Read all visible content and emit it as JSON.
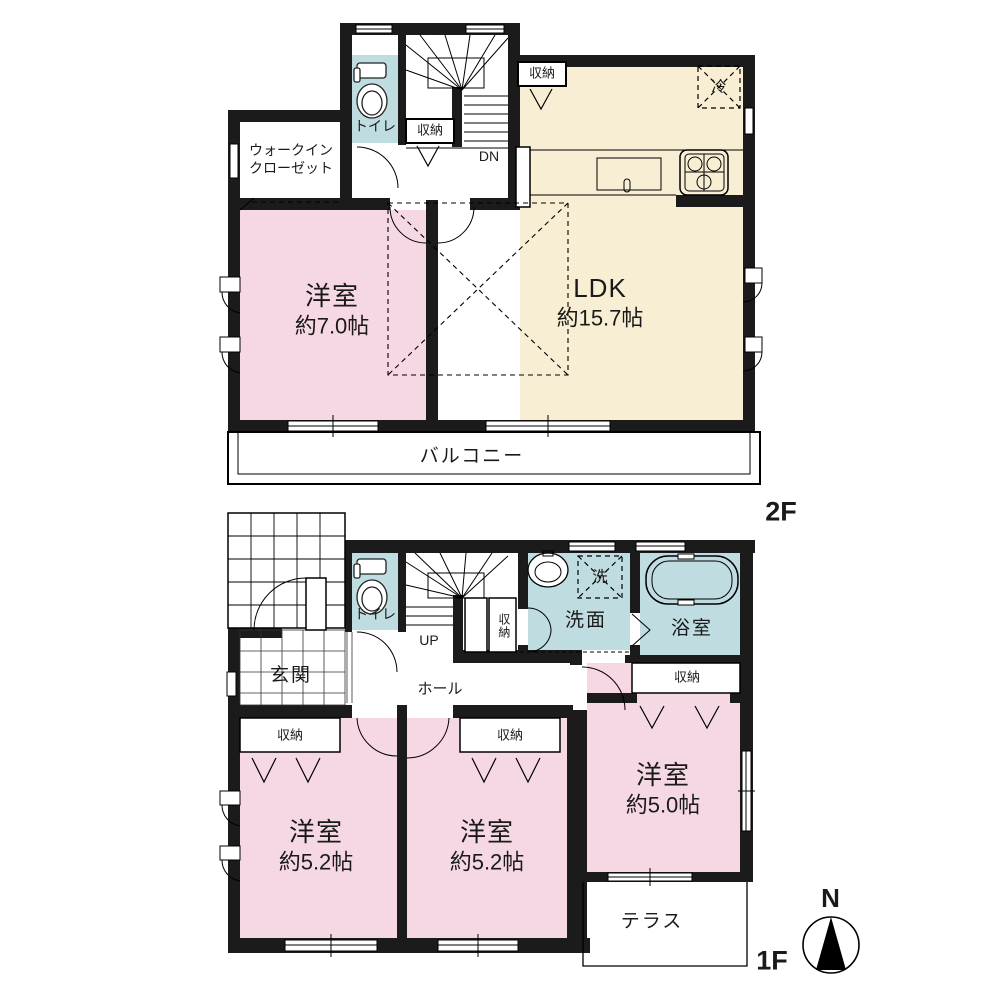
{
  "colors": {
    "wall": "#1b1b1b",
    "room_pink": "#f6d8e4",
    "room_cream": "#f8eed3",
    "room_blue": "#bfdce1"
  },
  "floor2": {
    "label": "2F",
    "walk_in_closet_line1": "ウォークイン",
    "walk_in_closet_line2": "クローゼット",
    "toilet": "トイレ",
    "stair_storage": "収納",
    "down": "DN",
    "ldk_storage": "収納",
    "fridge": "冷",
    "ldk_name": "LDK",
    "ldk_size": "約15.7帖",
    "bedroom_name": "洋室",
    "bedroom_size": "約7.0帖",
    "balcony": "バルコニー"
  },
  "floor1": {
    "label": "1F",
    "entrance": "玄関",
    "toilet": "トイレ",
    "up": "UP",
    "under_stair_storage": "収納",
    "laundry": "洗",
    "washroom": "洗面",
    "bathroom": "浴室",
    "bath_storage": "収納",
    "hall": "ホール",
    "closet_left": "収納",
    "closet_middle": "収納",
    "bedroom1_name": "洋室",
    "bedroom1_size": "約5.2帖",
    "bedroom2_name": "洋室",
    "bedroom2_size": "約5.2帖",
    "bedroom3_name": "洋室",
    "bedroom3_size": "約5.0帖",
    "terrace": "テラス"
  },
  "compass": {
    "north": "N"
  }
}
